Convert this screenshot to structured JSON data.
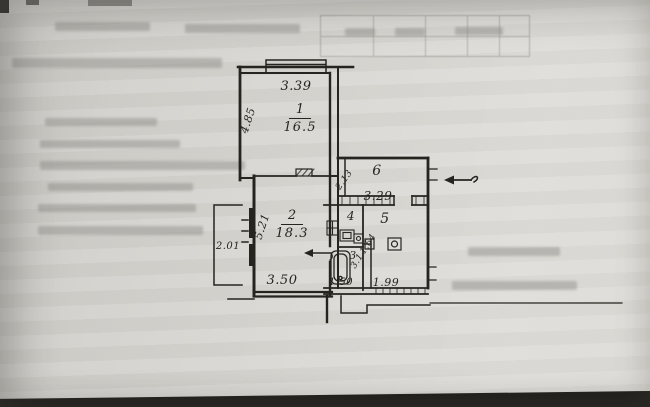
{
  "photo": {
    "paper_color": "#d8d6d1",
    "ink_color": "#26241f"
  },
  "plan": {
    "rooms": [
      {
        "number": "1",
        "area": "16.5",
        "dims": {
          "top": "3.39",
          "side": "4.85"
        }
      },
      {
        "number": "2",
        "area": "18.3",
        "dims": {
          "bottom": "3.50",
          "side": "5.21"
        }
      },
      {
        "number": "3",
        "dims": {
          "bottom": "1.50"
        }
      },
      {
        "number": "4"
      },
      {
        "number": "5",
        "dims": {
          "bottom": "1.99"
        }
      },
      {
        "number": "6",
        "dims": {
          "bottom": "3.29",
          "side": "2.13"
        }
      }
    ],
    "balcony": {
      "dim": "2.01"
    },
    "corridor": {
      "dims": [
        "1.64",
        "3.1"
      ]
    }
  }
}
